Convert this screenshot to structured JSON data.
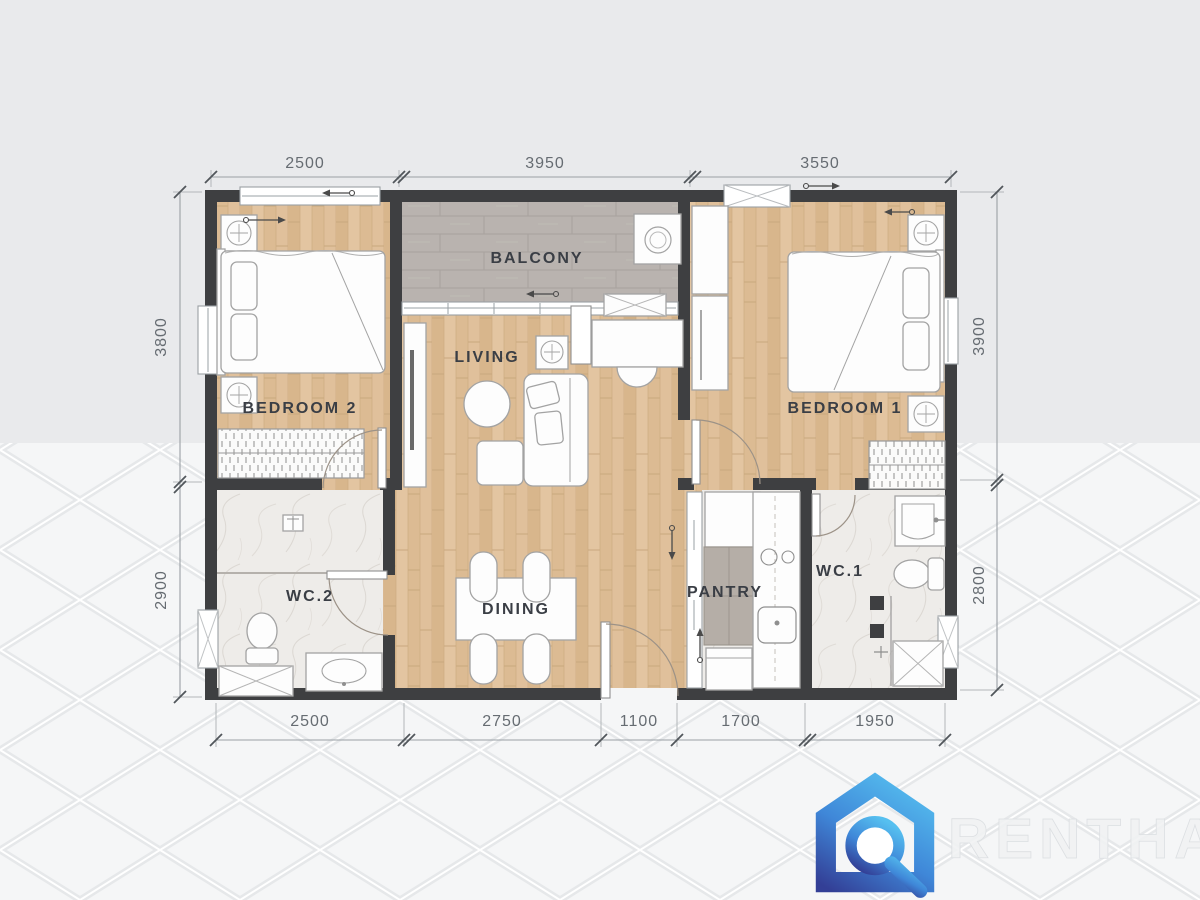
{
  "rooms": {
    "bedroom2": "BEDROOM 2",
    "balcony": "BALCONY",
    "living": "LIVING",
    "bedroom1": "BEDROOM 1",
    "wc2": "WC.2",
    "dining": "DINING",
    "pantry": "PANTRY",
    "wc1": "WC.1"
  },
  "dimensions": {
    "top": [
      "2500",
      "3950",
      "3550"
    ],
    "bottom": [
      "2500",
      "2750",
      "1100",
      "1700",
      "1950"
    ],
    "left": [
      "3800",
      "2900"
    ],
    "right": [
      "3900",
      "2800"
    ]
  },
  "watermark": {
    "brand": "RENTHAI"
  },
  "colors": {
    "wall": "#3e3f41",
    "wood_floor": "#ddbd96",
    "balcony_tile": "#b9b3af",
    "wet_room_floor": "#eeece9",
    "background_top": "#e9eaec",
    "background_bottom": "#f5f6f7",
    "logo_blue_light": "#56c0f0",
    "logo_blue_dark": "#333f96",
    "dimension_text": "#666c72",
    "label_text": "#3a3e45"
  }
}
